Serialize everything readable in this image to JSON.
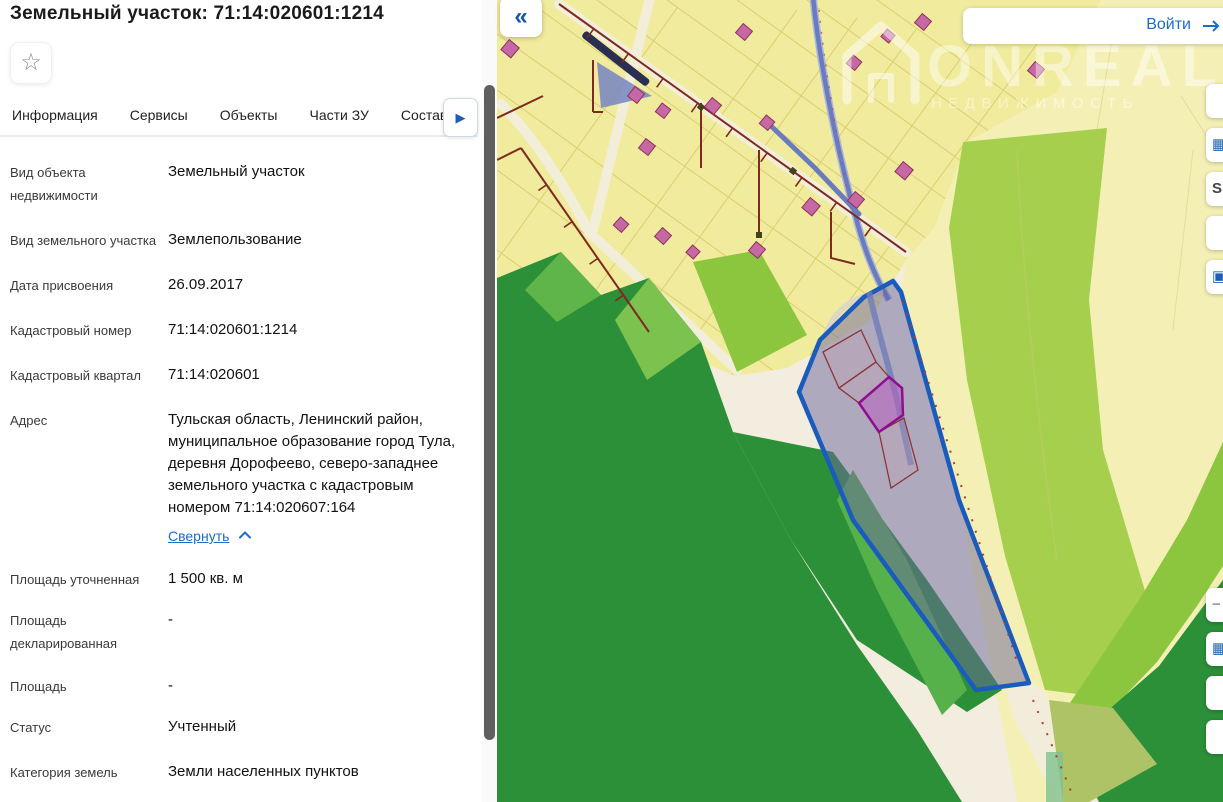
{
  "panel": {
    "title": "Земельный участок: 71:14:020601:1214",
    "favorite_icon": "☆",
    "tabs": [
      {
        "label": "Информация",
        "active": true
      },
      {
        "label": "Сервисы"
      },
      {
        "label": "Объекты"
      },
      {
        "label": "Части ЗУ"
      },
      {
        "label": "Состав"
      }
    ],
    "tabs_more_icon": "▶",
    "fields": [
      {
        "label": "Вид объекта недвижимости",
        "value": "Земельный участок"
      },
      {
        "label": "Вид земельного участка",
        "value": "Землепользование"
      },
      {
        "label": "Дата присвоения",
        "value": "26.09.2017"
      },
      {
        "label": "Кадастровый номер",
        "value": "71:14:020601:1214"
      },
      {
        "label": "Кадастровый квартал",
        "value": "71:14:020601"
      },
      {
        "label": "Адрес",
        "value": "Тульская область, Ленинский район, муниципальное образование город Тула, деревня Дорофеево, северо-западнее земельного участка с кадастровым номером 71:14:020607:164",
        "link": "Свернуть"
      },
      {
        "label": "Площадь уточненная",
        "value": "1 500 кв. м"
      },
      {
        "label": "Площадь декларированная",
        "value": "-"
      },
      {
        "label": "Площадь",
        "value": "-"
      },
      {
        "label": "Статус",
        "value": "Учтенный"
      },
      {
        "label": "Категория земель",
        "value": "Земли населенных пунктов"
      }
    ]
  },
  "map": {
    "collapse_icon": "«",
    "login": {
      "label": "Войти",
      "icon": "arrow-right"
    },
    "watermark": {
      "brand": "ONREAL",
      "subtitle": "НЕДВИЖИМОСТЬ"
    },
    "selected_parcel": "71:14:020601:1214",
    "controls_top": [
      {
        "icon": ""
      },
      {
        "icon": "▦"
      },
      {
        "icon": "S"
      },
      {
        "icon": ""
      },
      {
        "icon": "▣"
      }
    ],
    "controls_bottom": [
      {
        "icon": "−"
      },
      {
        "icon": "▦"
      },
      {
        "icon": ""
      },
      {
        "icon": ""
      }
    ],
    "colors": {
      "parcel_yellow": "#f1eb9e",
      "pale_yellow": "#f4f0b5",
      "bright_green": "#a6cf4d",
      "dark_green": "#2c9039",
      "selected_outline": "#1a5bbe",
      "selected_fill": "rgba(108,102,158,0.5)",
      "highlight_magenta": "#8e0f8e",
      "building_pink": "#c668a4",
      "powerline_maroon": "#7e2a20",
      "road_blue": "#6b7cbe"
    }
  }
}
